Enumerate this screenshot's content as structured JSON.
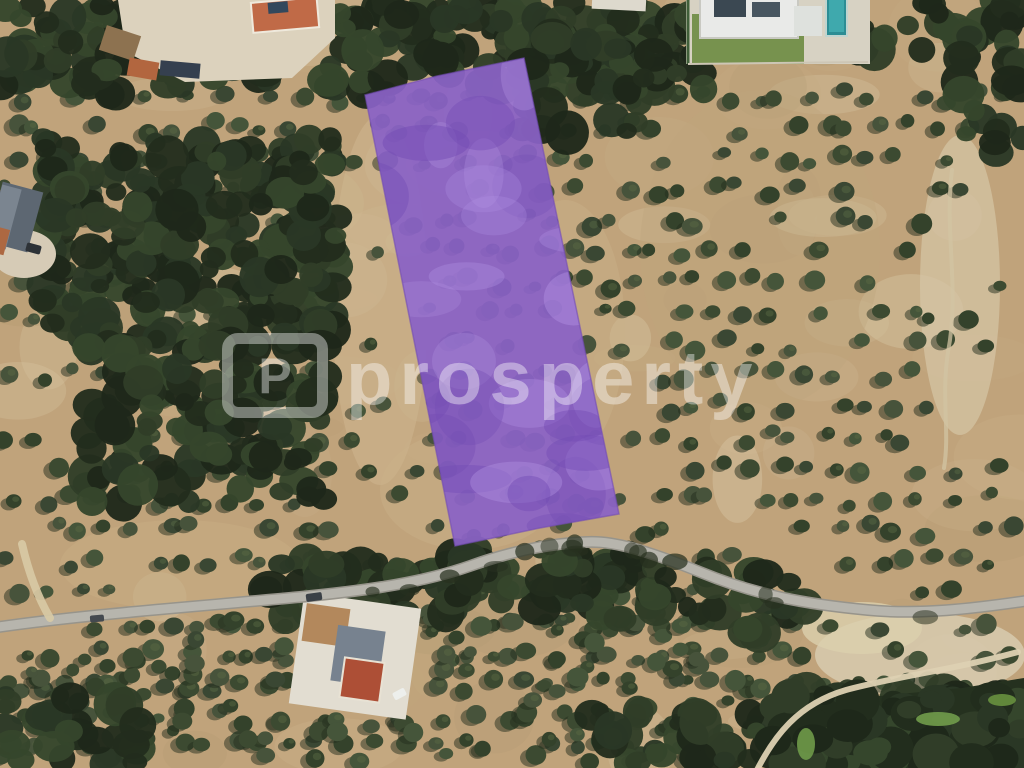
{
  "watermark": {
    "text": "prosperty",
    "logo_letter": "P",
    "color": "#ffffff",
    "opacity": 0.4
  },
  "parcel": {
    "points": [
      [
        365,
        95
      ],
      [
        437,
        76
      ],
      [
        524,
        58
      ],
      [
        619,
        514
      ],
      [
        540,
        528
      ],
      [
        455,
        546
      ]
    ],
    "fill": "#8a62c6",
    "opacity": 0.93,
    "mottle_light": "#b191e2",
    "mottle_dark": "#734cb4"
  },
  "palette": {
    "soil": "#c0a37b",
    "soil_light": "#dcd0b2",
    "tree_green": "#3c4a31",
    "forest_green": "#2a3725",
    "road_gray": "#b7b5ad",
    "road_edge": "#97948b",
    "dirt_track": "#d8caa5",
    "pool_teal": "#2c8d94",
    "lawn_green": "#77924e"
  },
  "roads": {
    "main": {
      "d": "M -8 628 C 80 615 180 608 300 597 C 372 590 424 582 470 566 C 512 551 550 543 588 542 C 614 541 646 550 700 572 C 756 595 804 604 868 610 C 918 615 972 609 1032 600",
      "fill": "#b7b5ad",
      "casing": "#97948b",
      "w": 9
    },
    "dirt_spur": {
      "d": "M 22 544 C 28 570 36 594 50 618",
      "stroke": "#d8caa5",
      "w": 8,
      "opacity": 0.9
    },
    "dirt_path_right": {
      "d": "M 952 170 C 944 230 960 290 948 352 C 941 398 950 432 944 468",
      "stroke": "#d2c4a3",
      "w": 4,
      "opacity": 0.75
    },
    "dirt_track_bottom_right": {
      "d": "M 756 772 C 774 736 798 704 846 690 C 898 676 952 670 1018 652",
      "stroke": "#ddd1b2",
      "w": 6,
      "opacity": 0.95
    }
  },
  "ground_patches": [
    {
      "cx": 960,
      "cy": 285,
      "rx": 40,
      "ry": 150,
      "fill": "#d5c6a6",
      "o": 0.7
    },
    {
      "cx": 920,
      "cy": 655,
      "rx": 105,
      "ry": 42,
      "fill": "#d6c9ac",
      "o": 0.9
    },
    {
      "cx": 862,
      "cy": 628,
      "rx": 60,
      "ry": 26,
      "fill": "#dbcfae",
      "o": 0.8
    },
    {
      "cx": 380,
      "cy": 300,
      "rx": 48,
      "ry": 185,
      "fill": "#cdb78f",
      "o": 0.55
    },
    {
      "cx": 565,
      "cy": 330,
      "rx": 60,
      "ry": 130,
      "fill": "#c9b28a",
      "o": 0.45
    },
    {
      "cx": 470,
      "cy": 490,
      "rx": 90,
      "ry": 60,
      "fill": "#cab189",
      "o": 0.45
    },
    {
      "cx": 180,
      "cy": 565,
      "rx": 120,
      "ry": 45,
      "fill": "#c7ad83",
      "o": 0.5
    },
    {
      "cx": 760,
      "cy": 250,
      "rx": 120,
      "ry": 160,
      "fill": "#bfa67e",
      "o": 0.4
    }
  ],
  "grounds": [
    {
      "name": "clearing-top-left",
      "type": "poly",
      "points": [
        [
          118,
          0
        ],
        [
          335,
          0
        ],
        [
          335,
          38
        ],
        [
          292,
          78
        ],
        [
          185,
          82
        ],
        [
          126,
          52
        ]
      ],
      "fill": "#dcd2bd"
    },
    {
      "name": "estate-ground",
      "type": "rect",
      "x": 686,
      "y": 0,
      "w": 184,
      "h": 64,
      "rot": 0,
      "fill": "#d7d2c3"
    },
    {
      "name": "estate-lawn",
      "type": "rect",
      "x": 692,
      "y": 14,
      "w": 112,
      "h": 50,
      "rot": 0,
      "fill": "#77924e"
    },
    {
      "name": "compound-ground",
      "type": "rect",
      "x": 296,
      "y": 600,
      "w": 118,
      "h": 112,
      "rot": 8,
      "fill": "#e2ddd1"
    },
    {
      "name": "driveway-top-left",
      "type": "ellipse",
      "cx": 24,
      "cy": 254,
      "rx": 32,
      "ry": 24,
      "fill": "#d6cbb6"
    }
  ],
  "forest_mass": {
    "points": [
      [
        768,
        768
      ],
      [
        798,
        722
      ],
      [
        840,
        700
      ],
      [
        900,
        694
      ],
      [
        962,
        688
      ],
      [
        1024,
        678
      ],
      [
        1024,
        768
      ]
    ],
    "fill": "#25311f"
  },
  "green_patches": [
    {
      "cx": 806,
      "cy": 744,
      "rx": 9,
      "ry": 16,
      "fill": "#6f9a49"
    },
    {
      "cx": 938,
      "cy": 719,
      "rx": 22,
      "ry": 7,
      "fill": "#719c4b"
    },
    {
      "cx": 1002,
      "cy": 700,
      "rx": 14,
      "ry": 6,
      "fill": "#68913f"
    }
  ],
  "buildings": [
    {
      "name": "house-terracotta-top",
      "x": 252,
      "y": 0,
      "w": 66,
      "h": 30,
      "rot": -5,
      "fill": "#c06a47",
      "stroke": "#efe9dc"
    },
    {
      "name": "house-top-awning",
      "x": 268,
      "y": 2,
      "w": 20,
      "h": 11,
      "rot": -5,
      "fill": "#33485c"
    },
    {
      "name": "shed-brown",
      "x": 102,
      "y": 30,
      "w": 36,
      "h": 26,
      "rot": 18,
      "fill": "#8d7250"
    },
    {
      "name": "shed-orange",
      "x": 128,
      "y": 60,
      "w": 30,
      "h": 18,
      "rot": 10,
      "fill": "#b2663f"
    },
    {
      "name": "shed-dark-roof",
      "x": 160,
      "y": 62,
      "w": 40,
      "h": 15,
      "rot": 5,
      "fill": "#35404f"
    },
    {
      "name": "house-gray-left",
      "x": -6,
      "y": 186,
      "w": 42,
      "h": 62,
      "rot": 15,
      "fill": "#5d6772"
    },
    {
      "name": "house-gray-left-ridge",
      "x": -6,
      "y": 186,
      "w": 20,
      "h": 62,
      "rot": 15,
      "fill": "#7b8590"
    },
    {
      "name": "house-left-terracotta",
      "x": -6,
      "y": 228,
      "w": 13,
      "h": 26,
      "rot": 15,
      "fill": "#ad6841"
    },
    {
      "name": "greenhouse-roof",
      "x": 592,
      "y": -4,
      "w": 54,
      "h": 14,
      "rot": 3,
      "fill": "#ddd9cd"
    },
    {
      "name": "estate-house",
      "x": 700,
      "y": -6,
      "w": 98,
      "h": 44,
      "rot": 0,
      "fill": "#e9eae8",
      "stroke": "#c9c9c2"
    },
    {
      "name": "estate-solar-panel-1",
      "x": 714,
      "y": 0,
      "w": 32,
      "h": 17,
      "rot": 0,
      "fill": "#3b4852"
    },
    {
      "name": "estate-solar-panel-2",
      "x": 752,
      "y": 2,
      "w": 28,
      "h": 15,
      "rot": 0,
      "fill": "#485660"
    },
    {
      "name": "estate-wing",
      "x": 794,
      "y": 6,
      "w": 28,
      "h": 30,
      "rot": 0,
      "fill": "#dee1dd"
    },
    {
      "name": "swimming-pool",
      "x": 826,
      "y": -4,
      "w": 21,
      "h": 40,
      "rot": 0,
      "fill": "#2c8d94",
      "stroke": "#bfd4cf"
    },
    {
      "name": "swimming-pool-water",
      "x": 829,
      "y": 0,
      "w": 15,
      "h": 32,
      "rot": 0,
      "fill": "#3fa9ad"
    },
    {
      "name": "compound-tan-roof",
      "x": 304,
      "y": 606,
      "w": 44,
      "h": 38,
      "rot": 8,
      "fill": "#b3885c"
    },
    {
      "name": "compound-terrace",
      "x": 334,
      "y": 628,
      "w": 48,
      "h": 56,
      "rot": 8,
      "fill": "#77828f"
    },
    {
      "name": "compound-red-roof",
      "x": 342,
      "y": 660,
      "w": 40,
      "h": 40,
      "rot": 8,
      "fill": "#ad4f36",
      "stroke": "#e8e2d4"
    }
  ],
  "fences": [
    {
      "name": "estate-fence",
      "x1": 688,
      "y1": 0,
      "x2": 688,
      "y2": 64,
      "stroke": "#41603a",
      "w": 3
    },
    {
      "name": "estate-boundary",
      "x1": 688,
      "y1": 64,
      "x2": 868,
      "y2": 62,
      "stroke": "#cdc6b5",
      "w": 2
    }
  ],
  "cars": [
    {
      "name": "car-dark-road-1",
      "x": 306,
      "y": 593,
      "w": 16,
      "h": 8,
      "rot": -8,
      "fill": "#3a4046"
    },
    {
      "name": "car-dark-road-2",
      "x": 90,
      "y": 615,
      "w": 14,
      "h": 7,
      "rot": -5,
      "fill": "#44494f"
    },
    {
      "name": "car-white-bottom",
      "x": 393,
      "y": 690,
      "w": 13,
      "h": 8,
      "rot": -28,
      "fill": "#edefec"
    },
    {
      "name": "car-dark-house",
      "x": 26,
      "y": 244,
      "w": 15,
      "h": 9,
      "rot": 15,
      "fill": "#2d3237"
    }
  ]
}
